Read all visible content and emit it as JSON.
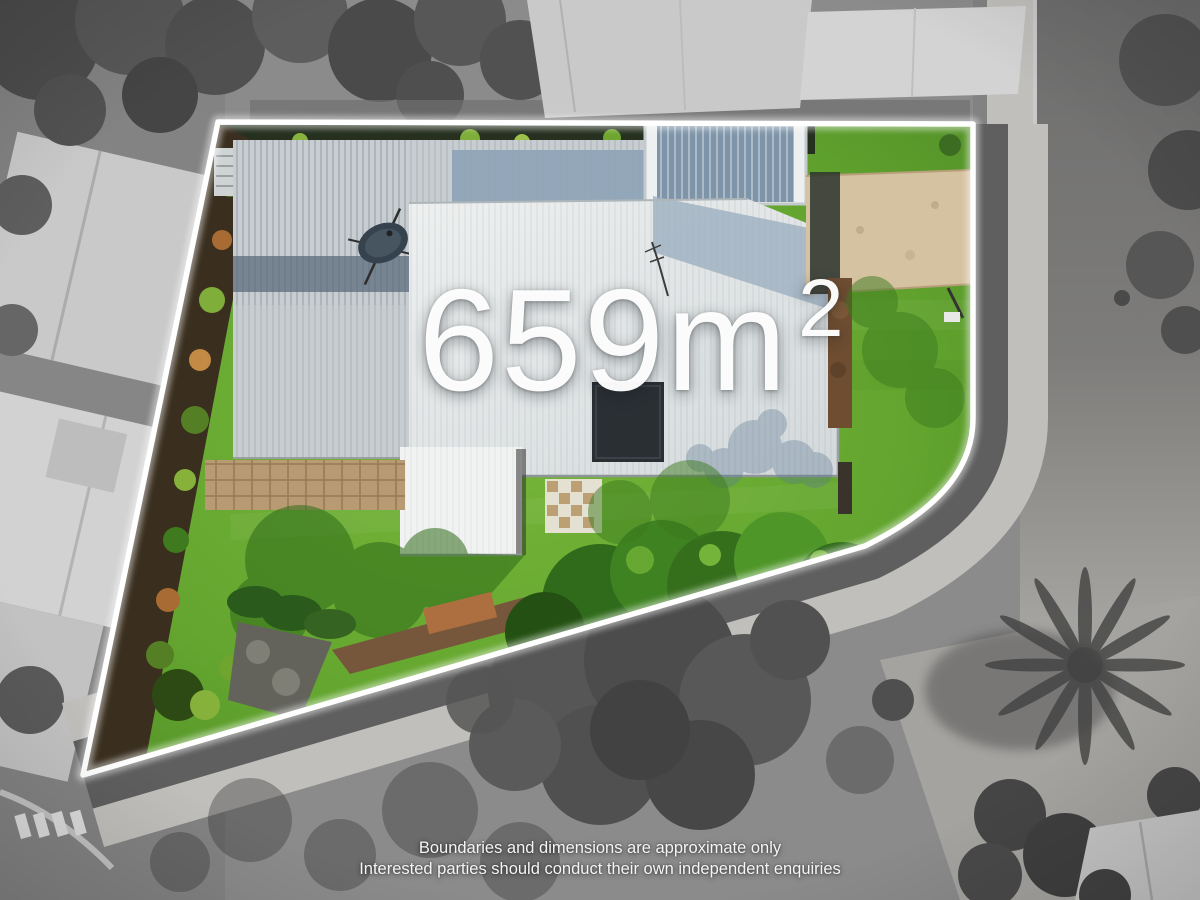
{
  "overlay": {
    "area_label": {
      "value": "659m",
      "superscript": "2"
    },
    "disclaimer": {
      "line1": "Boundaries and dimensions are approximate only",
      "line2": "Interested parties should conduct their own independent enquiries"
    }
  },
  "colors": {
    "boundary_line": "#ffffff",
    "lawn_green": "#64a52f",
    "lawn_shadow": "#3c7a1e",
    "driveway_tan": "#d5c2a1",
    "roof_light_gray": "#c7cdd0",
    "roof_white": "#e9eced",
    "roof_shaded_blue": "#8ea4b7",
    "road_gray": "#8b8b8b",
    "footpath_concrete": "#c0bfbc"
  }
}
